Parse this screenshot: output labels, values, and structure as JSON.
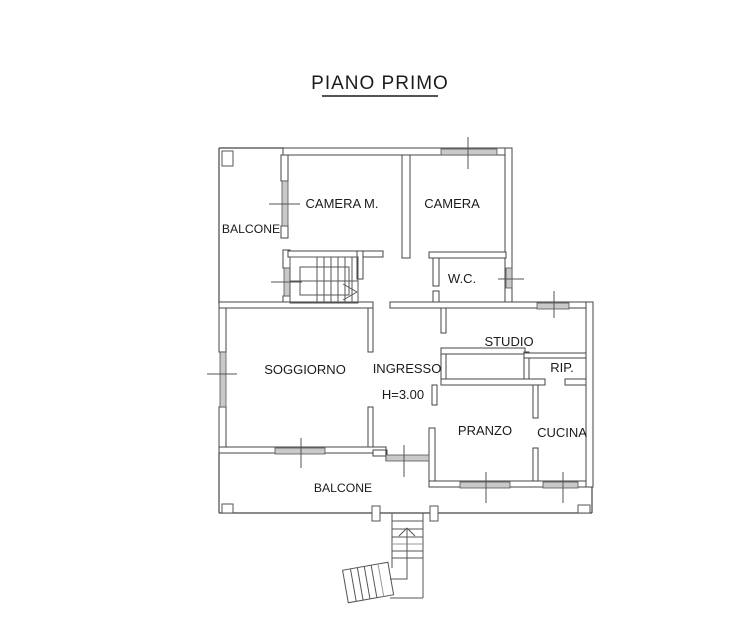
{
  "title": "PIANO PRIMO",
  "rooms": {
    "balcone_top": "BALCONE",
    "camera_m": "CAMERA M.",
    "camera": "CAMERA",
    "wc": "W.C.",
    "studio": "STUDIO",
    "rip": "RIP.",
    "soggiorno": "SOGGIORNO",
    "ingresso": "INGRESSO",
    "ingresso_height": "H=3.00",
    "pranzo": "PRANZO",
    "cucina": "CUCINA",
    "balcone_bottom": "BALCONE"
  },
  "colors": {
    "background": "#ffffff",
    "wall_line": "#454545",
    "detail_line": "#555555",
    "window_fill": "#c9c9c9",
    "label_text": "#1b1b1b"
  }
}
